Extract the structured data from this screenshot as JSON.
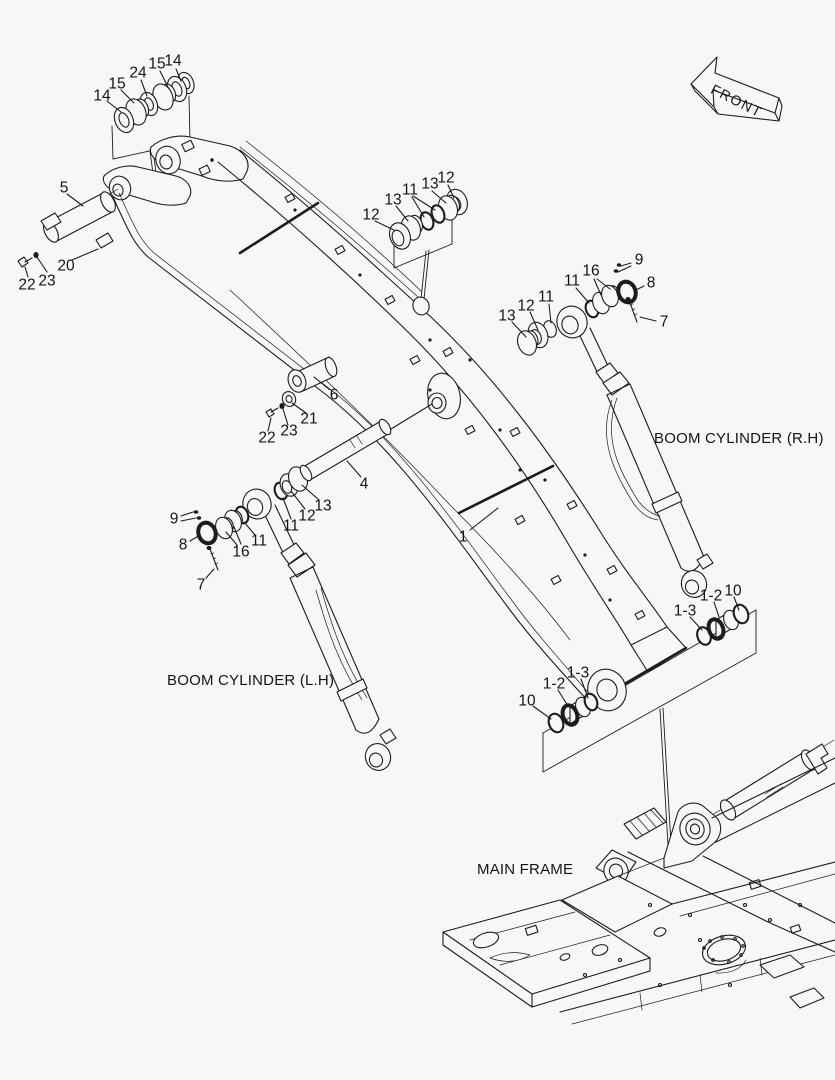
{
  "figure": {
    "front_label": "FRONT",
    "boom_cylinder_rh": "BOOM CYLINDER (R.H)",
    "boom_cylinder_lh": "BOOM CYLINDER (L.H)",
    "main_frame": "MAIN FRAME",
    "callouts": [
      {
        "text": "14",
        "x": 102,
        "y": 96
      },
      {
        "text": "15",
        "x": 117,
        "y": 84
      },
      {
        "text": "24",
        "x": 138,
        "y": 73
      },
      {
        "text": "15",
        "x": 157,
        "y": 64
      },
      {
        "text": "14",
        "x": 173,
        "y": 61
      },
      {
        "text": "5",
        "x": 64,
        "y": 188
      },
      {
        "text": "20",
        "x": 66,
        "y": 266
      },
      {
        "text": "22",
        "x": 27,
        "y": 285
      },
      {
        "text": "23",
        "x": 47,
        "y": 281
      },
      {
        "text": "12",
        "x": 371,
        "y": 215
      },
      {
        "text": "13",
        "x": 393,
        "y": 200
      },
      {
        "text": "11",
        "x": 410,
        "y": 190
      },
      {
        "text": "13",
        "x": 430,
        "y": 184
      },
      {
        "text": "12",
        "x": 446,
        "y": 178
      },
      {
        "text": "13",
        "x": 507,
        "y": 316
      },
      {
        "text": "12",
        "x": 526,
        "y": 306
      },
      {
        "text": "11",
        "x": 546,
        "y": 297
      },
      {
        "text": "11",
        "x": 572,
        "y": 281
      },
      {
        "text": "16",
        "x": 591,
        "y": 271
      },
      {
        "text": "9",
        "x": 639,
        "y": 260
      },
      {
        "text": "8",
        "x": 651,
        "y": 283
      },
      {
        "text": "7",
        "x": 664,
        "y": 322
      },
      {
        "text": "6",
        "x": 334,
        "y": 395
      },
      {
        "text": "21",
        "x": 309,
        "y": 419
      },
      {
        "text": "23",
        "x": 289,
        "y": 431
      },
      {
        "text": "22",
        "x": 267,
        "y": 438
      },
      {
        "text": "4",
        "x": 364,
        "y": 484
      },
      {
        "text": "1",
        "x": 463,
        "y": 537
      },
      {
        "text": "9",
        "x": 174,
        "y": 519
      },
      {
        "text": "8",
        "x": 183,
        "y": 545
      },
      {
        "text": "7",
        "x": 201,
        "y": 585
      },
      {
        "text": "16",
        "x": 241,
        "y": 552
      },
      {
        "text": "11",
        "x": 259,
        "y": 541
      },
      {
        "text": "11",
        "x": 291,
        "y": 526
      },
      {
        "text": "12",
        "x": 307,
        "y": 516
      },
      {
        "text": "13",
        "x": 323,
        "y": 506
      },
      {
        "text": "1-3",
        "x": 685,
        "y": 611
      },
      {
        "text": "1-2",
        "x": 711,
        "y": 596
      },
      {
        "text": "10",
        "x": 733,
        "y": 591
      },
      {
        "text": "10",
        "x": 527,
        "y": 701
      },
      {
        "text": "1-2",
        "x": 554,
        "y": 684
      },
      {
        "text": "1-3",
        "x": 578,
        "y": 673
      }
    ]
  },
  "style": {
    "background": "#f7f7f6",
    "line_color": "#1c1c1c"
  }
}
